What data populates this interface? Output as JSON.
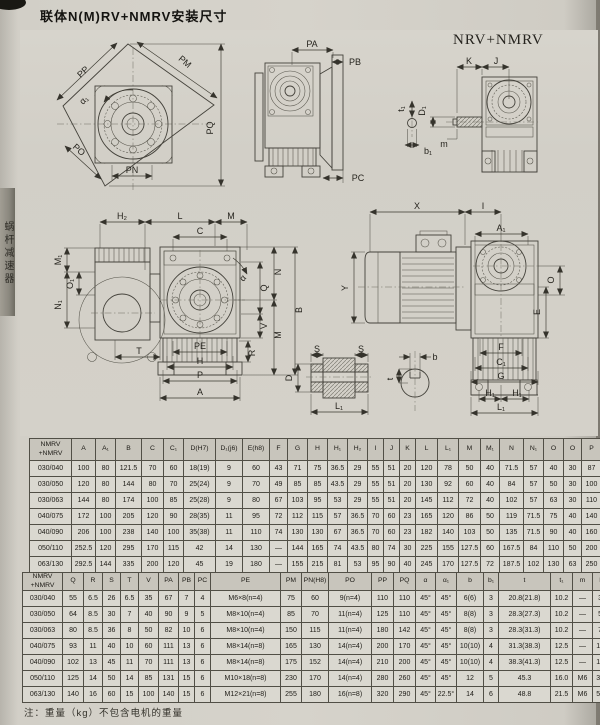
{
  "page": {
    "title": "联体N(M)RV+NMRV安装尺寸",
    "side_tab": "蜗杆减速器",
    "note": "注：重量（kg）不包含电机的重量"
  },
  "drawings": {
    "nrv_label": "NRV+NMRV",
    "flange": {
      "pp": "PP",
      "pm": "PM",
      "pq": "PQ",
      "po": "PO",
      "pn": "PN",
      "alpha1": "α₁"
    },
    "side": {
      "pa": "PA",
      "pb": "PB",
      "pc": "PC"
    },
    "input": {
      "k": "K",
      "j": "J",
      "d1": "D₁",
      "m": "m",
      "t1": "t₁",
      "b1": "b₁"
    },
    "front": {
      "h2": "H₂",
      "l": "L",
      "m_top": "M",
      "c": "C",
      "m1": "M₁",
      "o1": "O₁",
      "n1": "N₁",
      "n": "N",
      "q": "Q",
      "b": "B",
      "v": "V",
      "m_right": "M",
      "r": "R",
      "alpha": "α",
      "t": "T",
      "pe": "PE",
      "h": "H",
      "p": "P",
      "a": "A"
    },
    "motor": {
      "x": "X",
      "i": "I",
      "a1": "A₁",
      "y": "Y",
      "o": "O",
      "e": "E",
      "f": "F",
      "c1": "C₁",
      "g": "G",
      "h1a": "H₁",
      "h1b": "H₁",
      "l1": "L₁"
    },
    "hollow": {
      "s1": "S",
      "s2": "S",
      "d": "D",
      "l1": "L₁"
    },
    "key": {
      "b": "b",
      "t": "t"
    }
  },
  "table1": {
    "headers": [
      "NMRV\n+NMRV",
      "A",
      "A₁",
      "B",
      "C",
      "C₁",
      "D(H7)",
      "D₁(j6)",
      "E(h8)",
      "F",
      "G",
      "H",
      "H₁",
      "H₂",
      "I",
      "J",
      "K",
      "L",
      "L₁",
      "M",
      "M₁",
      "N",
      "N₁",
      "O",
      "O",
      "P"
    ],
    "rows": [
      [
        "030/040",
        "100",
        "80",
        "121.5",
        "70",
        "60",
        "18(19)",
        "9",
        "60",
        "43",
        "71",
        "75",
        "36.5",
        "29",
        "55",
        "51",
        "20",
        "120",
        "78",
        "50",
        "40",
        "71.5",
        "57",
        "40",
        "30",
        "87"
      ],
      [
        "030/050",
        "120",
        "80",
        "144",
        "80",
        "70",
        "25(24)",
        "9",
        "70",
        "49",
        "85",
        "85",
        "43.5",
        "29",
        "55",
        "51",
        "20",
        "130",
        "92",
        "60",
        "40",
        "84",
        "57",
        "50",
        "30",
        "100"
      ],
      [
        "030/063",
        "144",
        "80",
        "174",
        "100",
        "85",
        "25(28)",
        "9",
        "80",
        "67",
        "103",
        "95",
        "53",
        "29",
        "55",
        "51",
        "20",
        "145",
        "112",
        "72",
        "40",
        "102",
        "57",
        "63",
        "30",
        "110"
      ],
      [
        "040/075",
        "172",
        "100",
        "205",
        "120",
        "90",
        "28(35)",
        "11",
        "95",
        "72",
        "112",
        "115",
        "57",
        "36.5",
        "70",
        "60",
        "23",
        "165",
        "120",
        "86",
        "50",
        "119",
        "71.5",
        "75",
        "40",
        "140"
      ],
      [
        "040/090",
        "206",
        "100",
        "238",
        "140",
        "100",
        "35(38)",
        "11",
        "110",
        "74",
        "130",
        "130",
        "67",
        "36.5",
        "70",
        "60",
        "23",
        "182",
        "140",
        "103",
        "50",
        "135",
        "71.5",
        "90",
        "40",
        "160"
      ],
      [
        "050/110",
        "252.5",
        "120",
        "295",
        "170",
        "115",
        "42",
        "14",
        "130",
        "—",
        "144",
        "165",
        "74",
        "43.5",
        "80",
        "74",
        "30",
        "225",
        "155",
        "127.5",
        "60",
        "167.5",
        "84",
        "110",
        "50",
        "200"
      ],
      [
        "063/130",
        "292.5",
        "144",
        "335",
        "200",
        "120",
        "45",
        "19",
        "180",
        "—",
        "155",
        "215",
        "81",
        "53",
        "95",
        "90",
        "40",
        "245",
        "170",
        "127.5",
        "72",
        "187.5",
        "102",
        "130",
        "63",
        "250"
      ]
    ]
  },
  "table2": {
    "headers": [
      "NMRV\n+NMRV",
      "Q",
      "R",
      "S",
      "T",
      "V",
      "PA",
      "PB",
      "PC",
      "PE",
      "PM",
      "PN(H8)",
      "PO",
      "PP",
      "PQ",
      "α",
      "α₁",
      "b",
      "b₁",
      "t",
      "t₁",
      "m",
      "kg"
    ],
    "rows": [
      [
        "030/040",
        "55",
        "6.5",
        "26",
        "6.5",
        "35",
        "67",
        "7",
        "4",
        "M6×8(n=4)",
        "75",
        "60",
        "9(n=4)",
        "110",
        "110",
        "45°",
        "45°",
        "6(6)",
        "3",
        "20.8(21.8)",
        "10.2",
        "—",
        "3.9"
      ],
      [
        "030/050",
        "64",
        "8.5",
        "30",
        "7",
        "40",
        "90",
        "9",
        "5",
        "M8×10(n=4)",
        "85",
        "70",
        "11(n=4)",
        "125",
        "110",
        "45°",
        "45°",
        "8(8)",
        "3",
        "28.3(27.3)",
        "10.2",
        "—",
        "5.0"
      ],
      [
        "030/063",
        "80",
        "8.5",
        "36",
        "8",
        "50",
        "82",
        "10",
        "6",
        "M8×10(n=4)",
        "150",
        "115",
        "11(n=4)",
        "180",
        "142",
        "45°",
        "45°",
        "8(8)",
        "3",
        "28.3(31.3)",
        "10.2",
        "—",
        "7.8"
      ],
      [
        "040/075",
        "93",
        "11",
        "40",
        "10",
        "60",
        "111",
        "13",
        "6",
        "M8×14(n=8)",
        "165",
        "130",
        "14(n=4)",
        "200",
        "170",
        "45°",
        "45°",
        "10(10)",
        "4",
        "31.3(38.3)",
        "12.5",
        "—",
        "12.0"
      ],
      [
        "040/090",
        "102",
        "13",
        "45",
        "11",
        "70",
        "111",
        "13",
        "6",
        "M8×14(n=8)",
        "175",
        "152",
        "14(n=4)",
        "210",
        "200",
        "45°",
        "45°",
        "10(10)",
        "4",
        "38.3(41.3)",
        "12.5",
        "—",
        "16.0"
      ],
      [
        "050/110",
        "125",
        "14",
        "50",
        "14",
        "85",
        "131",
        "15",
        "6",
        "M10×18(n=8)",
        "230",
        "170",
        "14(n=4)",
        "280",
        "260",
        "45°",
        "45°",
        "12",
        "5",
        "45.3",
        "16.0",
        "M6",
        "39.2"
      ],
      [
        "063/130",
        "140",
        "16",
        "60",
        "15",
        "100",
        "140",
        "15",
        "6",
        "M12×21(n=8)",
        "255",
        "180",
        "16(n=8)",
        "320",
        "290",
        "45°",
        "22.5°",
        "14",
        "6",
        "48.8",
        "21.5",
        "M6",
        "55.0"
      ]
    ]
  }
}
